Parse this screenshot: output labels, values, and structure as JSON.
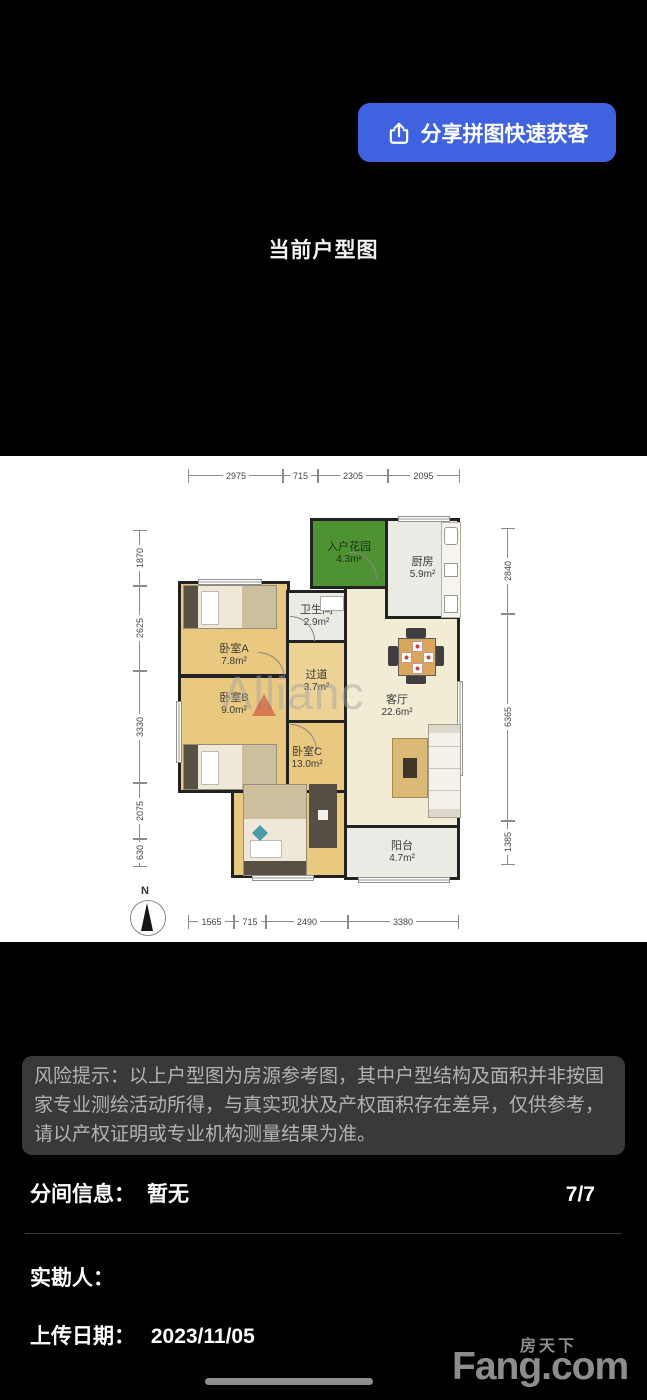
{
  "share_button": {
    "label": "分享拼图快速获客"
  },
  "title": "当前户型图",
  "floorplan": {
    "watermark": "Allianc",
    "compass": "N",
    "dims_top": [
      "2975",
      "715",
      "2305",
      "2095"
    ],
    "dims_bottom": [
      "1565",
      "715",
      "2490",
      "3380"
    ],
    "dims_left": [
      "1870",
      "2625",
      "3330",
      "2075",
      "630"
    ],
    "dims_right": [
      "2840",
      "6365",
      "1385"
    ],
    "rooms": [
      {
        "name": "入户花园",
        "area": "4.3m²"
      },
      {
        "name": "厨房",
        "area": "5.9m²"
      },
      {
        "name": "卫生间",
        "area": "2.9m²"
      },
      {
        "name": "卧室A",
        "area": "7.8m²"
      },
      {
        "name": "卧室B",
        "area": "9.0m²"
      },
      {
        "name": "过道",
        "area": "3.7m²"
      },
      {
        "name": "客厅",
        "area": "22.6m²"
      },
      {
        "name": "卧室C",
        "area": "13.0m²"
      },
      {
        "name": "阳台",
        "area": "4.7m²"
      }
    ]
  },
  "risk_notice": "风险提示：以上户型图为房源参考图，其中户型结构及面积并非按国家专业测绘活动所得，与真实现状及产权面积存在差异，仅供参考，请以产权证明或专业机构测量结果为准。",
  "partition": {
    "label": "分间信息：",
    "value": "暂无"
  },
  "pager": "7/7",
  "surveyor_label": "实勘人：",
  "upload": {
    "label": "上传日期：",
    "value": "2023/11/05"
  },
  "brand": {
    "cn": "房天下",
    "en": "Fang.com"
  },
  "colors": {
    "accent_blue": "#3F63E0",
    "risk_bg": "#39393B",
    "garden_green": "#4F9233",
    "wood": "#E9C87F"
  }
}
